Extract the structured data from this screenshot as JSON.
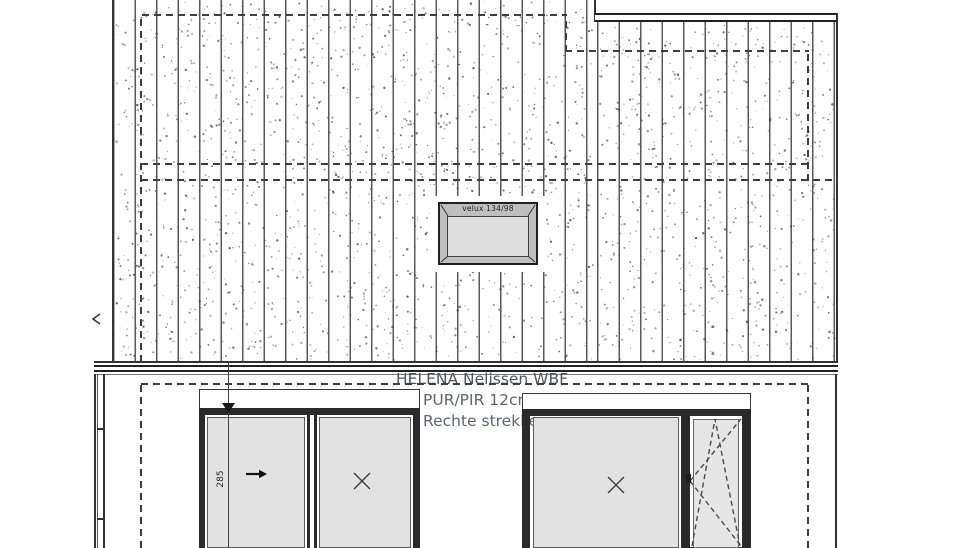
{
  "drawing": {
    "annotations": {
      "header_note": "HELENA Nelissen WBF",
      "insulation_note": "PUR/PIR 12cm",
      "bond_note": "Rechte strekker"
    },
    "skylight": {
      "label": "velux 134/98"
    },
    "dimensions": {
      "window_height": "285"
    },
    "symbols": {
      "fixed_pane": "x-mark",
      "sliding_direction": "right-arrow",
      "tilt_turn_sash": "dashed-triangles",
      "left_edge_mark": "chevron-left"
    },
    "colors": {
      "background": "#ffffff",
      "line": "#333333",
      "frame_dark": "#2a2a2a",
      "dash": "#3d3d3d",
      "glass": "#e2e2e2",
      "stipple": "#4a4a4a",
      "note_text": "#5d6570",
      "note_header": "#4e5560"
    }
  }
}
